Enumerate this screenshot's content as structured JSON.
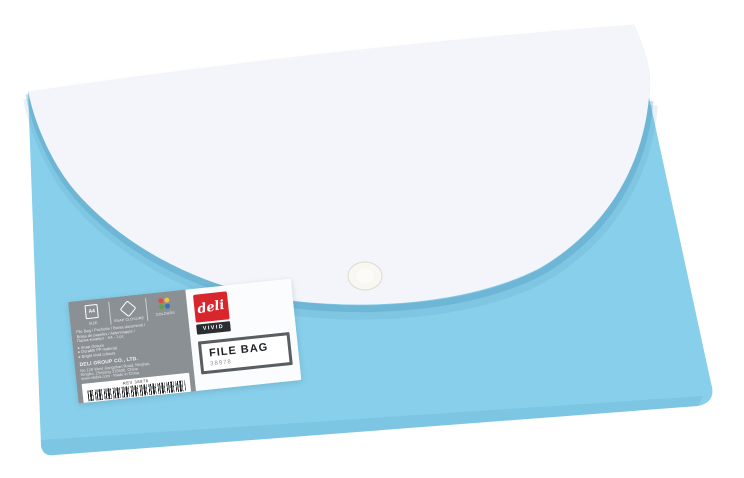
{
  "page": {
    "background": "#ffffff"
  },
  "photo": {
    "subject": "deli VIVID A4 file bag with snap closure, light blue body with white flap",
    "colors": {
      "bag_body_blue": "#87CFEA",
      "flap_white": "#F3F5FA",
      "label_gray": "#8B9095",
      "brand_red": "#D9252C",
      "badge_black": "#2B2E31",
      "box_border_gray": "#595E62"
    }
  },
  "label": {
    "specs": [
      {
        "icon": "a4-size-icon",
        "badge": "A4",
        "caption": "SIZE"
      },
      {
        "icon": "snap-closure-icon",
        "caption": "SNAP CLOSURE"
      },
      {
        "icon": "colours-icon",
        "caption": "COLOURS"
      }
    ],
    "description": {
      "line1": "File Bag / Pochette / Borsa documenti /",
      "line2": "Bolsa de papeles / Aktenmappe /",
      "line3": "Папка-конверт · A4 · 1 pc"
    },
    "bullets": [
      "Snap closure",
      "Durable PP material",
      "Bright vivid colours"
    ],
    "company": "DELI GROUP CO., LTD.",
    "address": {
      "line1": "No.128 West Jiangshan Road, Ninghai,",
      "line2": "Ningbo, Zhejiang 315600, China",
      "line3": "www.nbdeli.com · Made in China"
    },
    "barcode": {
      "rev": "REV 38978",
      "digits": "6 935205 389787"
    }
  },
  "brand": {
    "logo": "deli",
    "series": "VIVID"
  },
  "product": {
    "name": "FILE BAG",
    "sku": "38978"
  }
}
